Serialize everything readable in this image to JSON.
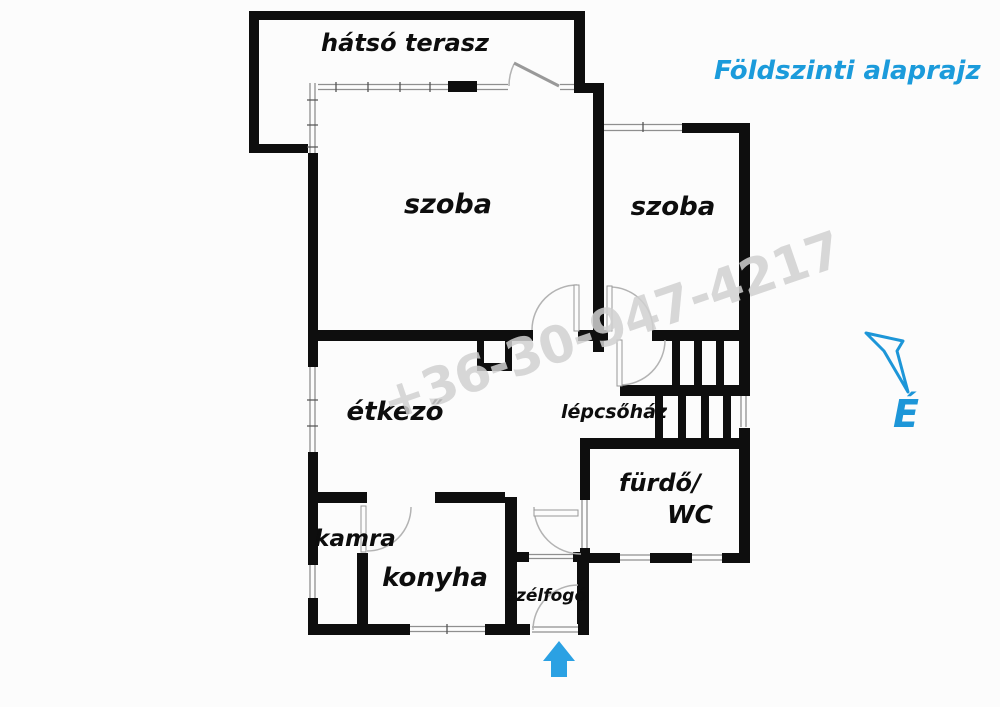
{
  "title": "Földszinti alaprajz",
  "watermark_phone": "+36-30-947-4217",
  "compass": {
    "north_label": "É"
  },
  "rooms": {
    "terrace": "hátsó terasz",
    "room1": "szoba",
    "room2": "szoba",
    "dining": "étkező",
    "stairwell": "lépcsőház",
    "bathroom_line1": "fürdő/",
    "bathroom_line2": "WC",
    "pantry": "kamra",
    "kitchen": "konyha",
    "vestibule": "szélfogó"
  },
  "colors": {
    "wall_black": "#0e0e0e",
    "accent_blue": "#1d96d8",
    "entrance_arrow_blue": "#2ba1e3",
    "watermark_gray": "#d0d0d0",
    "background": "#fcfcfc"
  }
}
